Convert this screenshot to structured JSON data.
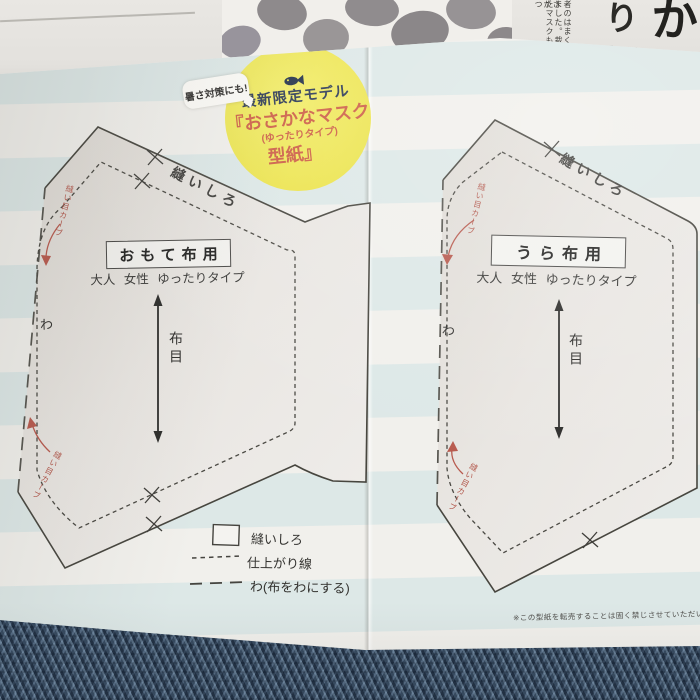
{
  "badge": {
    "tagline_bubble": "暑さ対策にも!",
    "line1": "最新限定モデル",
    "line2": "『おさかなマスク",
    "line3": "(ゆったりタイプ)",
    "line4": "型紙』"
  },
  "pieces": {
    "left": {
      "title": "おもて布用",
      "size": "大人 女性 ゆったりタイプ",
      "grain": "布目",
      "fold": "わ",
      "seam": "縫いしろ",
      "curve_top": "縫い目カーブ",
      "curve_bottom": "縫い目カーブ"
    },
    "right": {
      "title": "うら布用",
      "size": "大人 女性 ゆったりタイプ",
      "grain": "布目",
      "fold": "わ",
      "seam": "縫いしろ",
      "curve_top": "縫い目カーブ",
      "curve_bottom": "縫い目カーブ"
    }
  },
  "legend": {
    "items": [
      {
        "symbol": "solid-box",
        "label": "縫いしろ"
      },
      {
        "symbol": "dashed-line",
        "label": "仕上がり線"
      },
      {
        "symbol": "long-dash-line",
        "label": "わ(布をわにする)"
      }
    ]
  },
  "disclaimer": "※この型紙を転売することは固く禁じさせていただいています",
  "magazine": {
    "headline_right": "かな",
    "headline_left": "り切",
    "column_1": "者のはまくまさ",
    "column_2": "ました。裁縫が",
    "column_3": "たマスクも、つ"
  },
  "colors": {
    "badge_yellow": "#ece44f",
    "badge_red": "#cd5f46",
    "badge_navy": "#2d3a55",
    "stripe_blue": "#d9e6e6",
    "paper_white": "#f1f0ec",
    "denim_navy": "#2c3d52",
    "ink": "#45443f",
    "red_note": "#b2564a"
  }
}
